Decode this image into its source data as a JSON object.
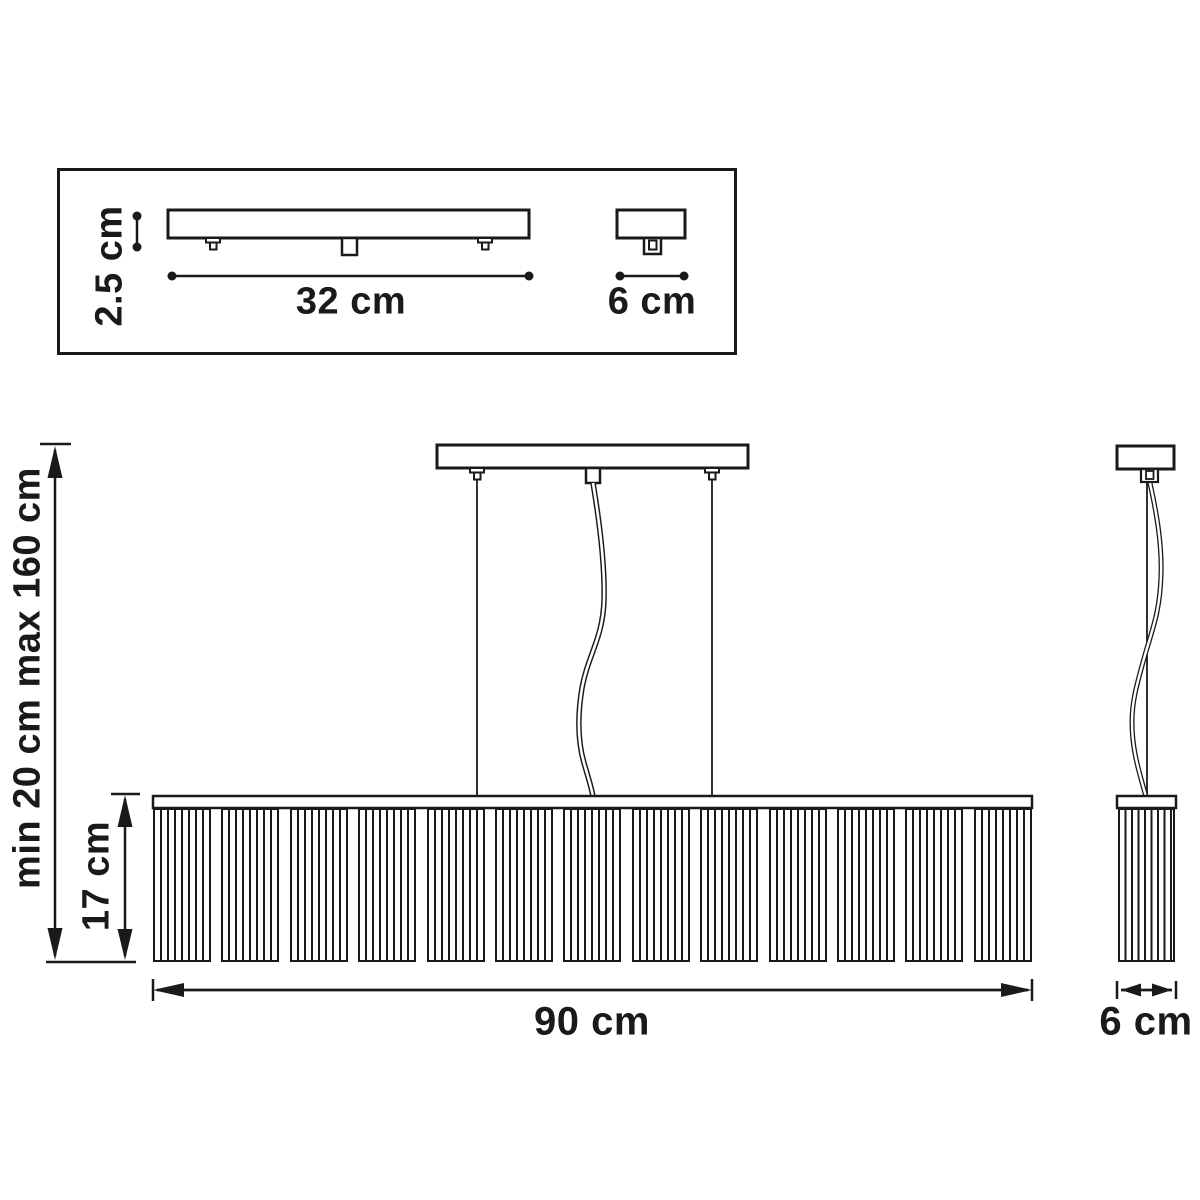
{
  "drawing": {
    "top_view": {
      "height_label": "2.5 cm",
      "length_label": "32 cm",
      "depth_label": "6 cm"
    },
    "front_view": {
      "suspension_label": "min 20 cm max 160 cm",
      "shade_height_label": "17 cm",
      "width_label": "90 cm"
    },
    "side_view": {
      "depth_label": "6 cm"
    },
    "colors": {
      "line": "#1a1a1a",
      "background": "#ffffff"
    }
  }
}
